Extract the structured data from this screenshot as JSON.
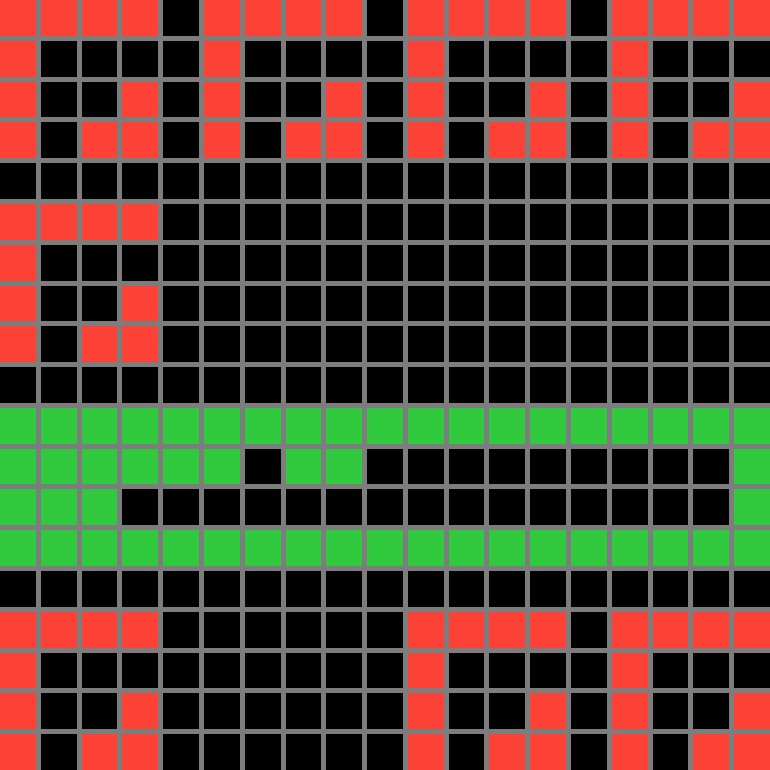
{
  "board": {
    "rows": 19,
    "cols": 19,
    "cell_pitch_px": 40.5,
    "grid_line_px": 5,
    "palette": {
      "R": "#fc4136",
      "G": "#31c93e",
      ".": "#000000"
    },
    "grid_line_color": "#7d7d7d",
    "background_color": "#000000",
    "cells": [
      "RRRR.RRRR.RRRR.RRRR",
      "R....R....R....R...",
      "R..R.R..R.R..R.R..R",
      "R.RR.R.RR.R.RR.R.RR",
      "...................",
      "RRRR...............",
      "R..................",
      "R..R...............",
      "R.RR...............",
      "...................",
      "GGGGGGGGGGGGGGGGGGG",
      "GGGGGG.GG.........G",
      "GGG...............G",
      "GGGGGGGGGGGGGGGGGGG",
      "...................",
      "RRRR......RRRR.RRRR",
      "R.........R....R...",
      "R..R......R..R.R..R",
      "R.RR......R.RR.R.RR"
    ],
    "legend": {
      "R": "red-cell",
      "G": "green-cell",
      ".": "empty-cell"
    }
  }
}
